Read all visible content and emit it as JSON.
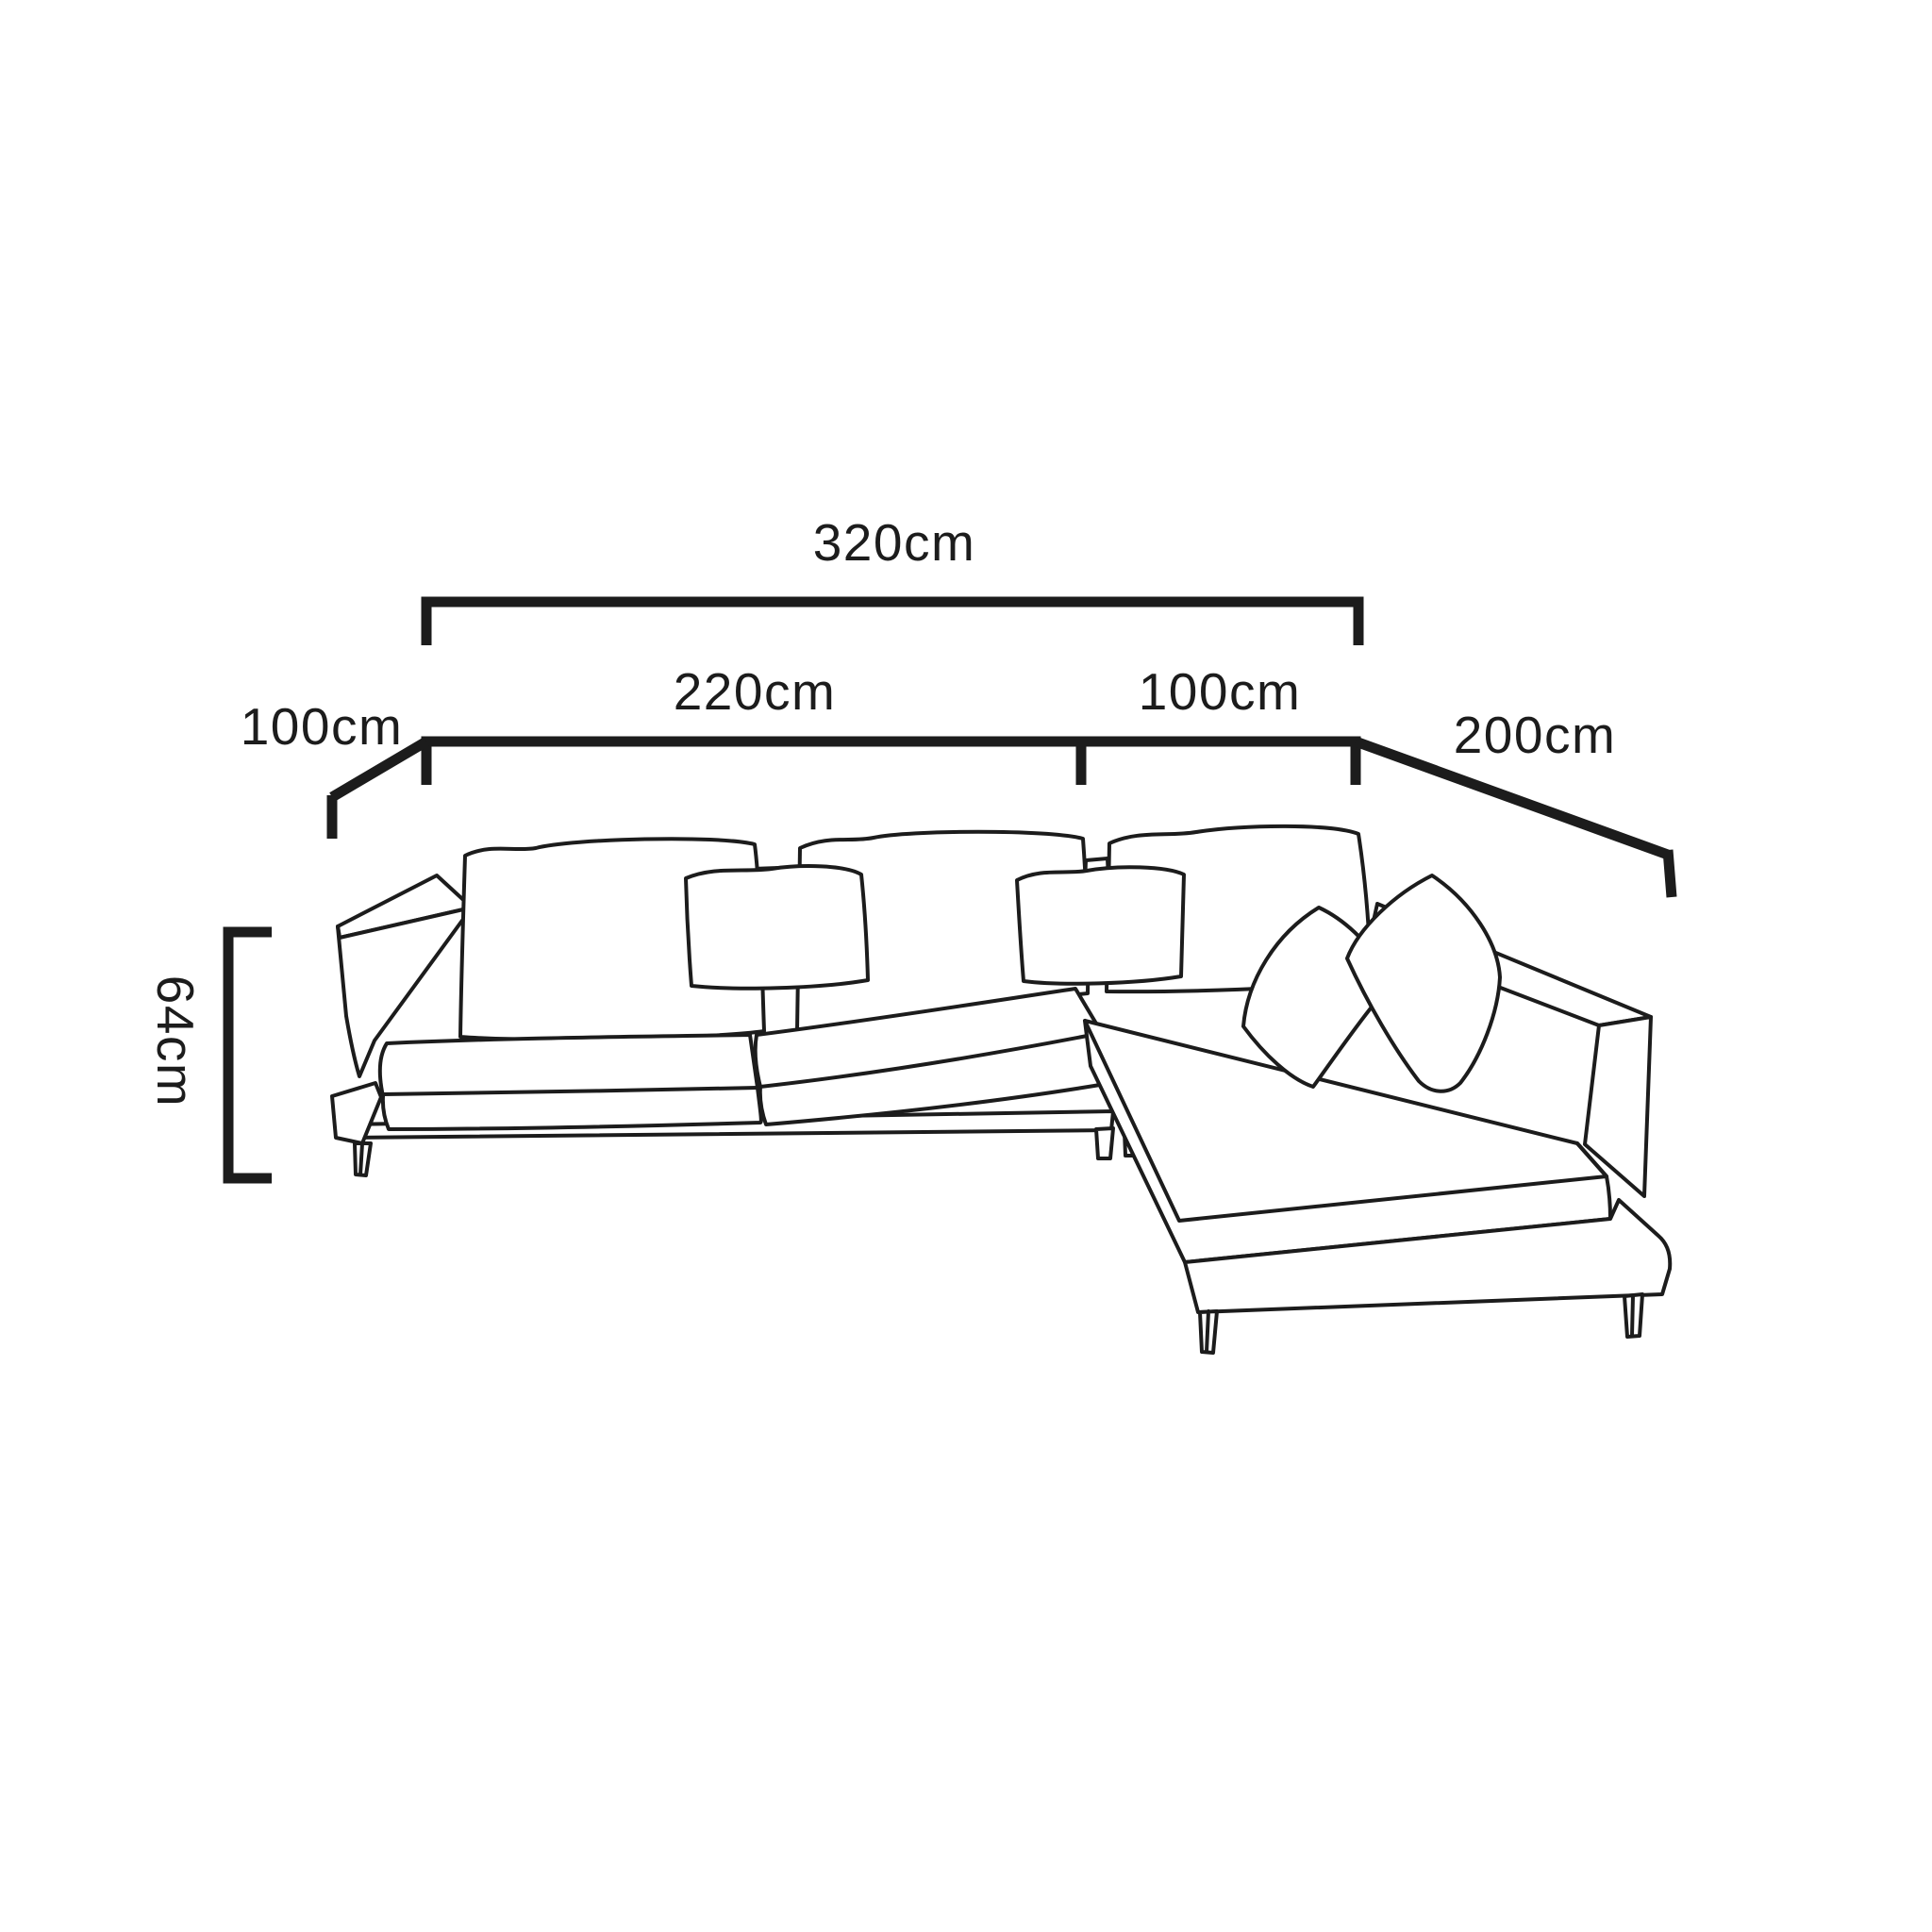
{
  "page": {
    "background_color": "#ffffff"
  },
  "diagram": {
    "subject": "L-shaped sectional sofa dimension line drawing",
    "line_color": "#1c1c1c",
    "text_color": "#1c1c1c",
    "labels": {
      "total_width": "320cm",
      "left_section_width": "220cm",
      "corner_section_width": "100cm",
      "side_depth": "100cm",
      "chaise_length": "200cm",
      "seat_height": "64cm"
    }
  }
}
